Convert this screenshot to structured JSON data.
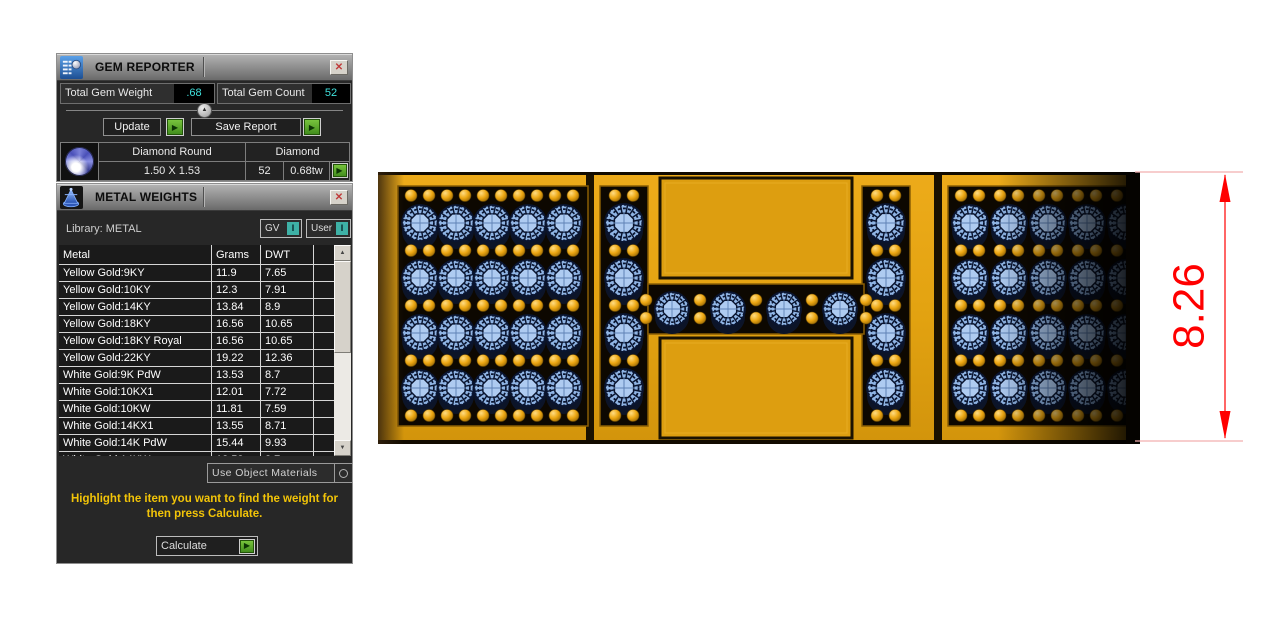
{
  "icons": {
    "close": "✕",
    "play": "▶",
    "collapse_up": "▲",
    "scroll_up": "▲",
    "scroll_down": "▼"
  },
  "colors": {
    "value_cyan": "#3FE0DC",
    "toggle_teal": "#3EB1A6",
    "action_green": "#4F9E24",
    "instruction_yellow": "#F2C408",
    "dimension_red": "#FF0000",
    "gold": "#E3A311",
    "gem_blue": "#8FB4E4"
  },
  "gem_reporter": {
    "title": "GEM REPORTER",
    "total_weight_label": "Total Gem Weight",
    "total_weight_value": ".68",
    "total_count_label": "Total Gem Count",
    "total_count_value": "52",
    "update_label": "Update",
    "save_report_label": "Save Report",
    "gem_row": {
      "cut_name": "Diamond Round",
      "material": "Diamond",
      "size": "1.50 X 1.53",
      "count": "52",
      "weight": "0.68tw"
    }
  },
  "metal_weights": {
    "title": "METAL WEIGHTS",
    "library_label": "Library: METAL",
    "gv_label": "GV",
    "gv_indicator": "I",
    "user_label": "User",
    "user_indicator": "I",
    "columns": [
      "Metal",
      "Grams",
      "DWT"
    ],
    "rows": [
      [
        "Yellow Gold:9KY",
        "11.9",
        "7.65"
      ],
      [
        "Yellow Gold:10KY",
        "12.3",
        "7.91"
      ],
      [
        "Yellow Gold:14KY",
        "13.84",
        "8.9"
      ],
      [
        "Yellow Gold:18KY",
        "16.56",
        "10.65"
      ],
      [
        "Yellow Gold:18KY Royal",
        "16.56",
        "10.65"
      ],
      [
        "Yellow Gold:22KY",
        "19.22",
        "12.36"
      ],
      [
        "White Gold:9K PdW",
        "13.53",
        "8.7"
      ],
      [
        "White Gold:10KX1",
        "12.01",
        "7.72"
      ],
      [
        "White Gold:10KW",
        "11.81",
        "7.59"
      ],
      [
        "White Gold:14KX1",
        "13.55",
        "8.71"
      ],
      [
        "White Gold:14K PdW",
        "15.44",
        "9.93"
      ],
      [
        "White Gold:14KW",
        "13.53",
        "8.7"
      ]
    ],
    "use_object_materials_label": "Use Object Materials",
    "instruction": "Highlight the item you want to find the weight for then press Calculate.",
    "calculate_label": "Calculate"
  },
  "viewport": {
    "dimension_value": "8.26",
    "gem_count_total": 52,
    "layout": {
      "left_grid": {
        "cols": 5,
        "rows": 4
      },
      "right_grid": {
        "cols": 5,
        "rows": 4
      },
      "h_left_column": 4,
      "h_right_column": 4,
      "h_crossbar": 4
    }
  }
}
